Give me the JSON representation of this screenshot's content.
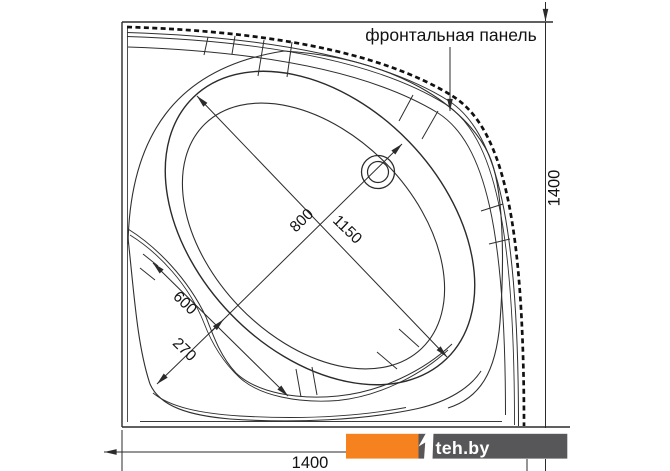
{
  "drawing": {
    "panel_label": "фронтальная панель",
    "dims": {
      "overall_width": "1400",
      "overall_depth": "1400",
      "basin_width": "800",
      "basin_length": "1150",
      "seat_width": "600",
      "corner_offset": "270"
    }
  },
  "watermark": {
    "text": "teh.by",
    "orange": "#F6821F",
    "gray": "#57575A"
  },
  "colors": {
    "line": "#2B2B2B",
    "background": "#FFFFFF"
  }
}
